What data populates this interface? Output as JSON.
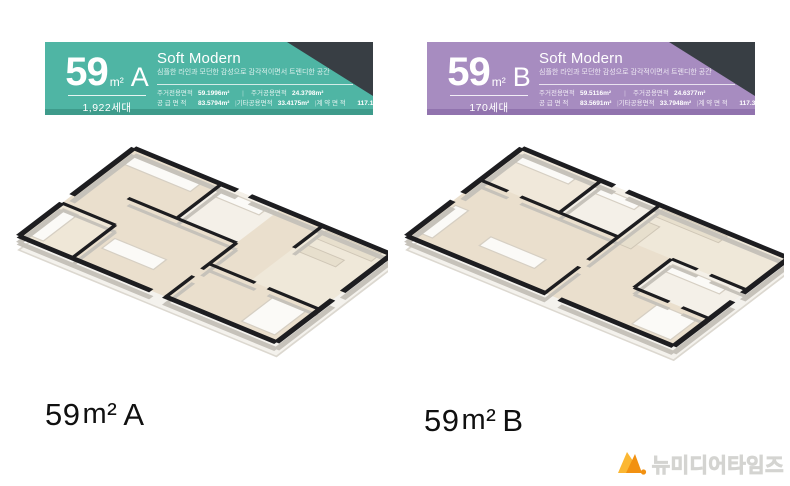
{
  "page": {
    "background": "#ffffff"
  },
  "spec_divider": "|",
  "panels": [
    {
      "caption": {
        "number": "59",
        "unit": "m²",
        "letter": "A"
      },
      "banner": {
        "accent": "#4FB5A4",
        "accent_dark": "#3E9B8B",
        "corner_color": "#383E44",
        "size_number": "59",
        "size_unit": "m²",
        "type_letter": "A",
        "household_count": "1,922세대",
        "concept_title": "Soft Modern",
        "concept_subtitle": "심플한 라인과 모던한 감성으로 감각적이면서 트렌디한 공간",
        "specs_row1": [
          {
            "label": "주거전용면적",
            "value": "59.1996m²"
          },
          {
            "label": "주거공용면적",
            "value": "24.3798m²"
          }
        ],
        "specs_row2": [
          {
            "label": "공 급 면 적",
            "value": "83.5794m²"
          },
          {
            "label": "기타공용면적",
            "value": "33.4175m²"
          },
          {
            "label": "계 약 면 적",
            "value": "117.1947m²"
          }
        ]
      }
    },
    {
      "caption": {
        "number": "59",
        "unit": "m²",
        "letter": "B"
      },
      "banner": {
        "accent": "#A78CC0",
        "accent_dark": "#9173AE",
        "corner_color": "#383E44",
        "size_number": "59",
        "size_unit": "m²",
        "type_letter": "B",
        "household_count": "170세대",
        "concept_title": "Soft Modern",
        "concept_subtitle": "심플한 라인과 모던한 감성으로 감각적이면서 트렌디한 공간",
        "specs_row1": [
          {
            "label": "주거전용면적",
            "value": "59.5116m²"
          },
          {
            "label": "주거공용면적",
            "value": "24.6377m²"
          }
        ],
        "specs_row2": [
          {
            "label": "공 급 면 적",
            "value": "83.5691m²"
          },
          {
            "label": "기타공용면적",
            "value": "33.7948m²"
          },
          {
            "label": "계 약 면 적",
            "value": "117.3636m²"
          }
        ]
      }
    }
  ],
  "watermark": {
    "text": "뉴미디어타임즈",
    "icon_colors": {
      "left": "#FBB733",
      "right": "#F29111",
      "dot": "#F29111"
    }
  }
}
